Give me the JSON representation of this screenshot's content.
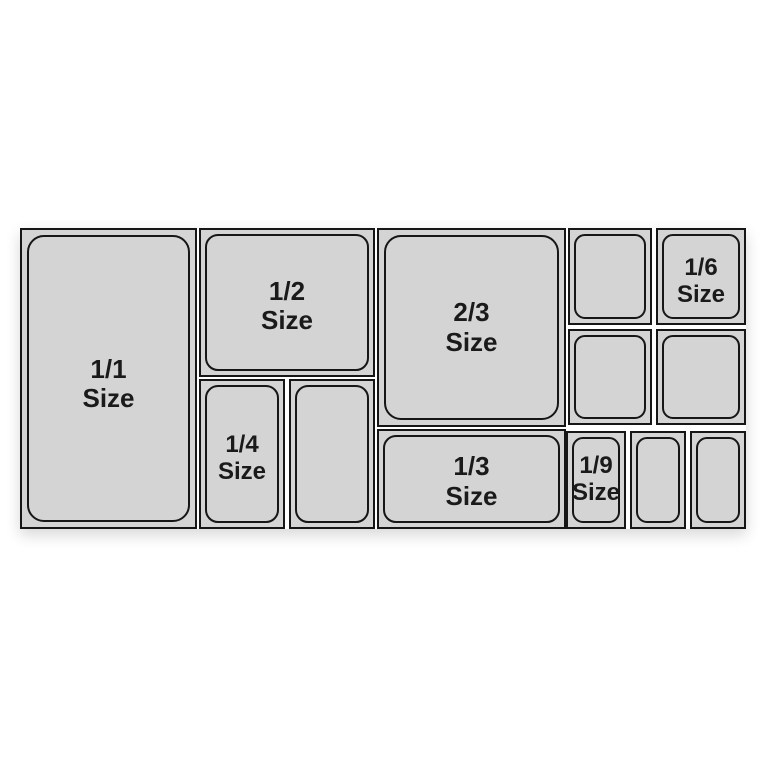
{
  "diagram": {
    "kind": "gastronorm-pan-size-layout",
    "colors": {
      "background": "#ffffff",
      "pan_fill": "#d4d4d4",
      "pan_border": "#161616",
      "label_text": "#1a1a1a"
    },
    "pans": [
      {
        "name": "pan-1-1",
        "label": "1/1\nSize"
      },
      {
        "name": "pan-1-2",
        "label": "1/2\nSize"
      },
      {
        "name": "pan-1-4",
        "label": "1/4\nSize"
      },
      {
        "name": "pan-1-4-unlabeled",
        "label": ""
      },
      {
        "name": "pan-2-3",
        "label": "2/3\nSize"
      },
      {
        "name": "pan-1-3",
        "label": "1/3\nSize"
      },
      {
        "name": "pan-1-6-top-left",
        "label": ""
      },
      {
        "name": "pan-1-6",
        "label": "1/6\nSize"
      },
      {
        "name": "pan-1-6-bottom-left",
        "label": ""
      },
      {
        "name": "pan-1-6-bottom-right",
        "label": ""
      },
      {
        "name": "pan-1-9",
        "label": "1/9\nSize"
      },
      {
        "name": "pan-1-9-unlabeled-2",
        "label": ""
      },
      {
        "name": "pan-1-9-unlabeled-3",
        "label": ""
      }
    ]
  }
}
